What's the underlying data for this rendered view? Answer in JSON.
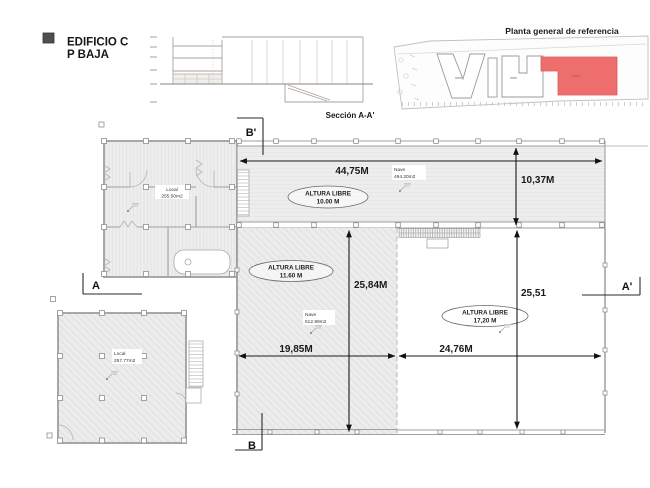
{
  "header": {
    "title1": "EDIFICIO C",
    "title2": "P BAJA"
  },
  "section_view": {
    "label": "Sección A-A'"
  },
  "site_plan": {
    "title": "Planta general de referencia",
    "highlight_color": "#ee6e6e"
  },
  "plan": {
    "markers": {
      "a": "A",
      "a_prime": "A'",
      "b": "B",
      "b_prime": "B'"
    },
    "dims": {
      "top_width": "44,75M",
      "band_height": "10,37M",
      "mid_height": "25,84M",
      "right_height": "25,51",
      "mid_width": "19,85M",
      "right_width": "24,76M"
    },
    "heights": [
      {
        "title": "ALTURA LIBRE",
        "value": "10.00 M"
      },
      {
        "title": "ALTURA LIBRE",
        "value": "11.60 M"
      },
      {
        "title": "ALTURA LIBRE",
        "value": "17,20 M"
      }
    ],
    "rooms": {
      "local_upper": {
        "type": "Local",
        "area": "255.50m2"
      },
      "nave_top": {
        "type": "Nave",
        "area": "494.20m2"
      },
      "nave_mid": {
        "type": "Nave",
        "area": "512.99m2"
      },
      "local_lower": {
        "type": "Local",
        "area": "257.77m2"
      }
    }
  }
}
